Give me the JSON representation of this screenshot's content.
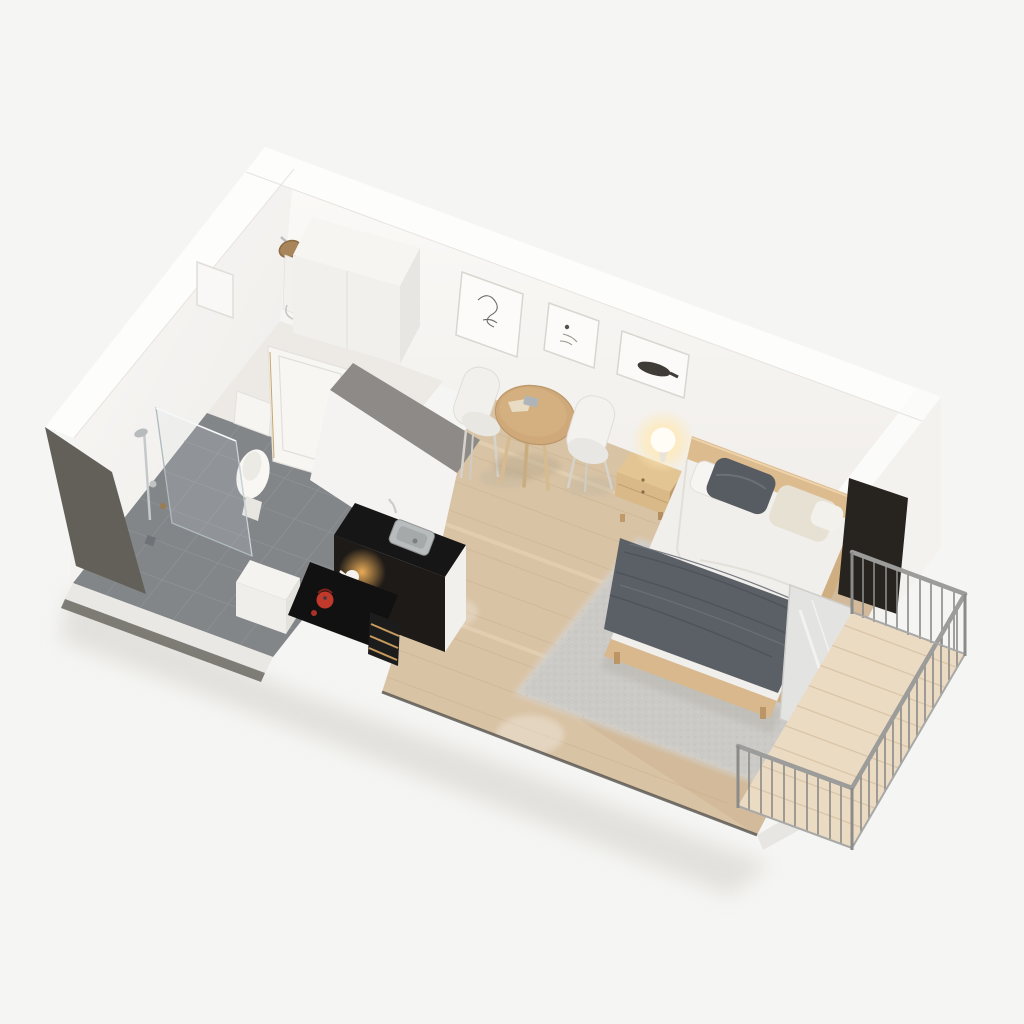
{
  "meta": {
    "description": "3D isometric cutaway render of a studio apartment floor plan, viewed from above at an angle, on a plain light background",
    "view": "axonometric bird's-eye, walls cut dollhouse-style",
    "visible_text": "none"
  },
  "rooms": [
    {
      "id": "entry-shower-nook",
      "label": "Entry / shower nook",
      "items": [
        "bronze shower head",
        "shower control panel",
        "tall white wardrobe column",
        "entrance door"
      ]
    },
    {
      "id": "bathroom",
      "label": "Bathroom",
      "floor": "grey ceramic tile",
      "items": [
        "walk-in shower glass screen",
        "chrome shower column",
        "toilet",
        "white vanity block",
        "open white door"
      ]
    },
    {
      "id": "kitchenette",
      "label": "Kitchenette",
      "items": [
        "black countertop",
        "stainless sink with faucet",
        "black cooktop",
        "red kettle",
        "white teapot on lit shelf",
        "oven with wood drawer pulls",
        "grey partition bulkhead"
      ]
    },
    {
      "id": "living-bedroom",
      "label": "Living / sleeping area",
      "floor": "light oak parquet",
      "items": [
        "round wooden dining table",
        "two white shell chairs",
        "three framed artworks",
        "wooden nightstand",
        "glowing table lamp",
        "double bed with grey throw",
        "grey area rug"
      ]
    },
    {
      "id": "balcony",
      "label": "Balcony",
      "floor": "wood decking",
      "items": [
        "metal railing with vertical balusters",
        "sliding glass door"
      ]
    }
  ],
  "furniture_counts": {
    "chairs": 2,
    "art_frames": 3,
    "pillows": 4,
    "beds": 1,
    "tables": 1
  },
  "colors": {
    "background": "#f5f5f3",
    "wall_white": "#f8f7f5",
    "wall_band": "#fdfdfc",
    "wall_interior": "#f6f4f1",
    "dark_cut_face": "#63605a",
    "tile_floor": "#838689",
    "tile_grout": "#919497",
    "wood_floor": "#d9c3a5",
    "plank_line": "#cdb592",
    "rug": "#cccac6",
    "bulkhead_grey": "#8d8a87",
    "counter_black": "#161616",
    "steel": "#b9bcbd",
    "kettle_red": "#c0392b",
    "glow_warm": "#ffde9e",
    "wood_furniture": "#dcbb8e",
    "wood_table": "#cfa97a",
    "duvet_white": "#f1efeb",
    "throw_grey": "#5b5f66",
    "pillow_dark": "#575b62",
    "pillow_beige": "#e7e1d4",
    "deck_wood": "#ecdbc3",
    "deck_line": "#d9c5a7",
    "railing_metal": "#8f8f8d",
    "glass_tint": "rgba(210,225,232,0.16)"
  }
}
